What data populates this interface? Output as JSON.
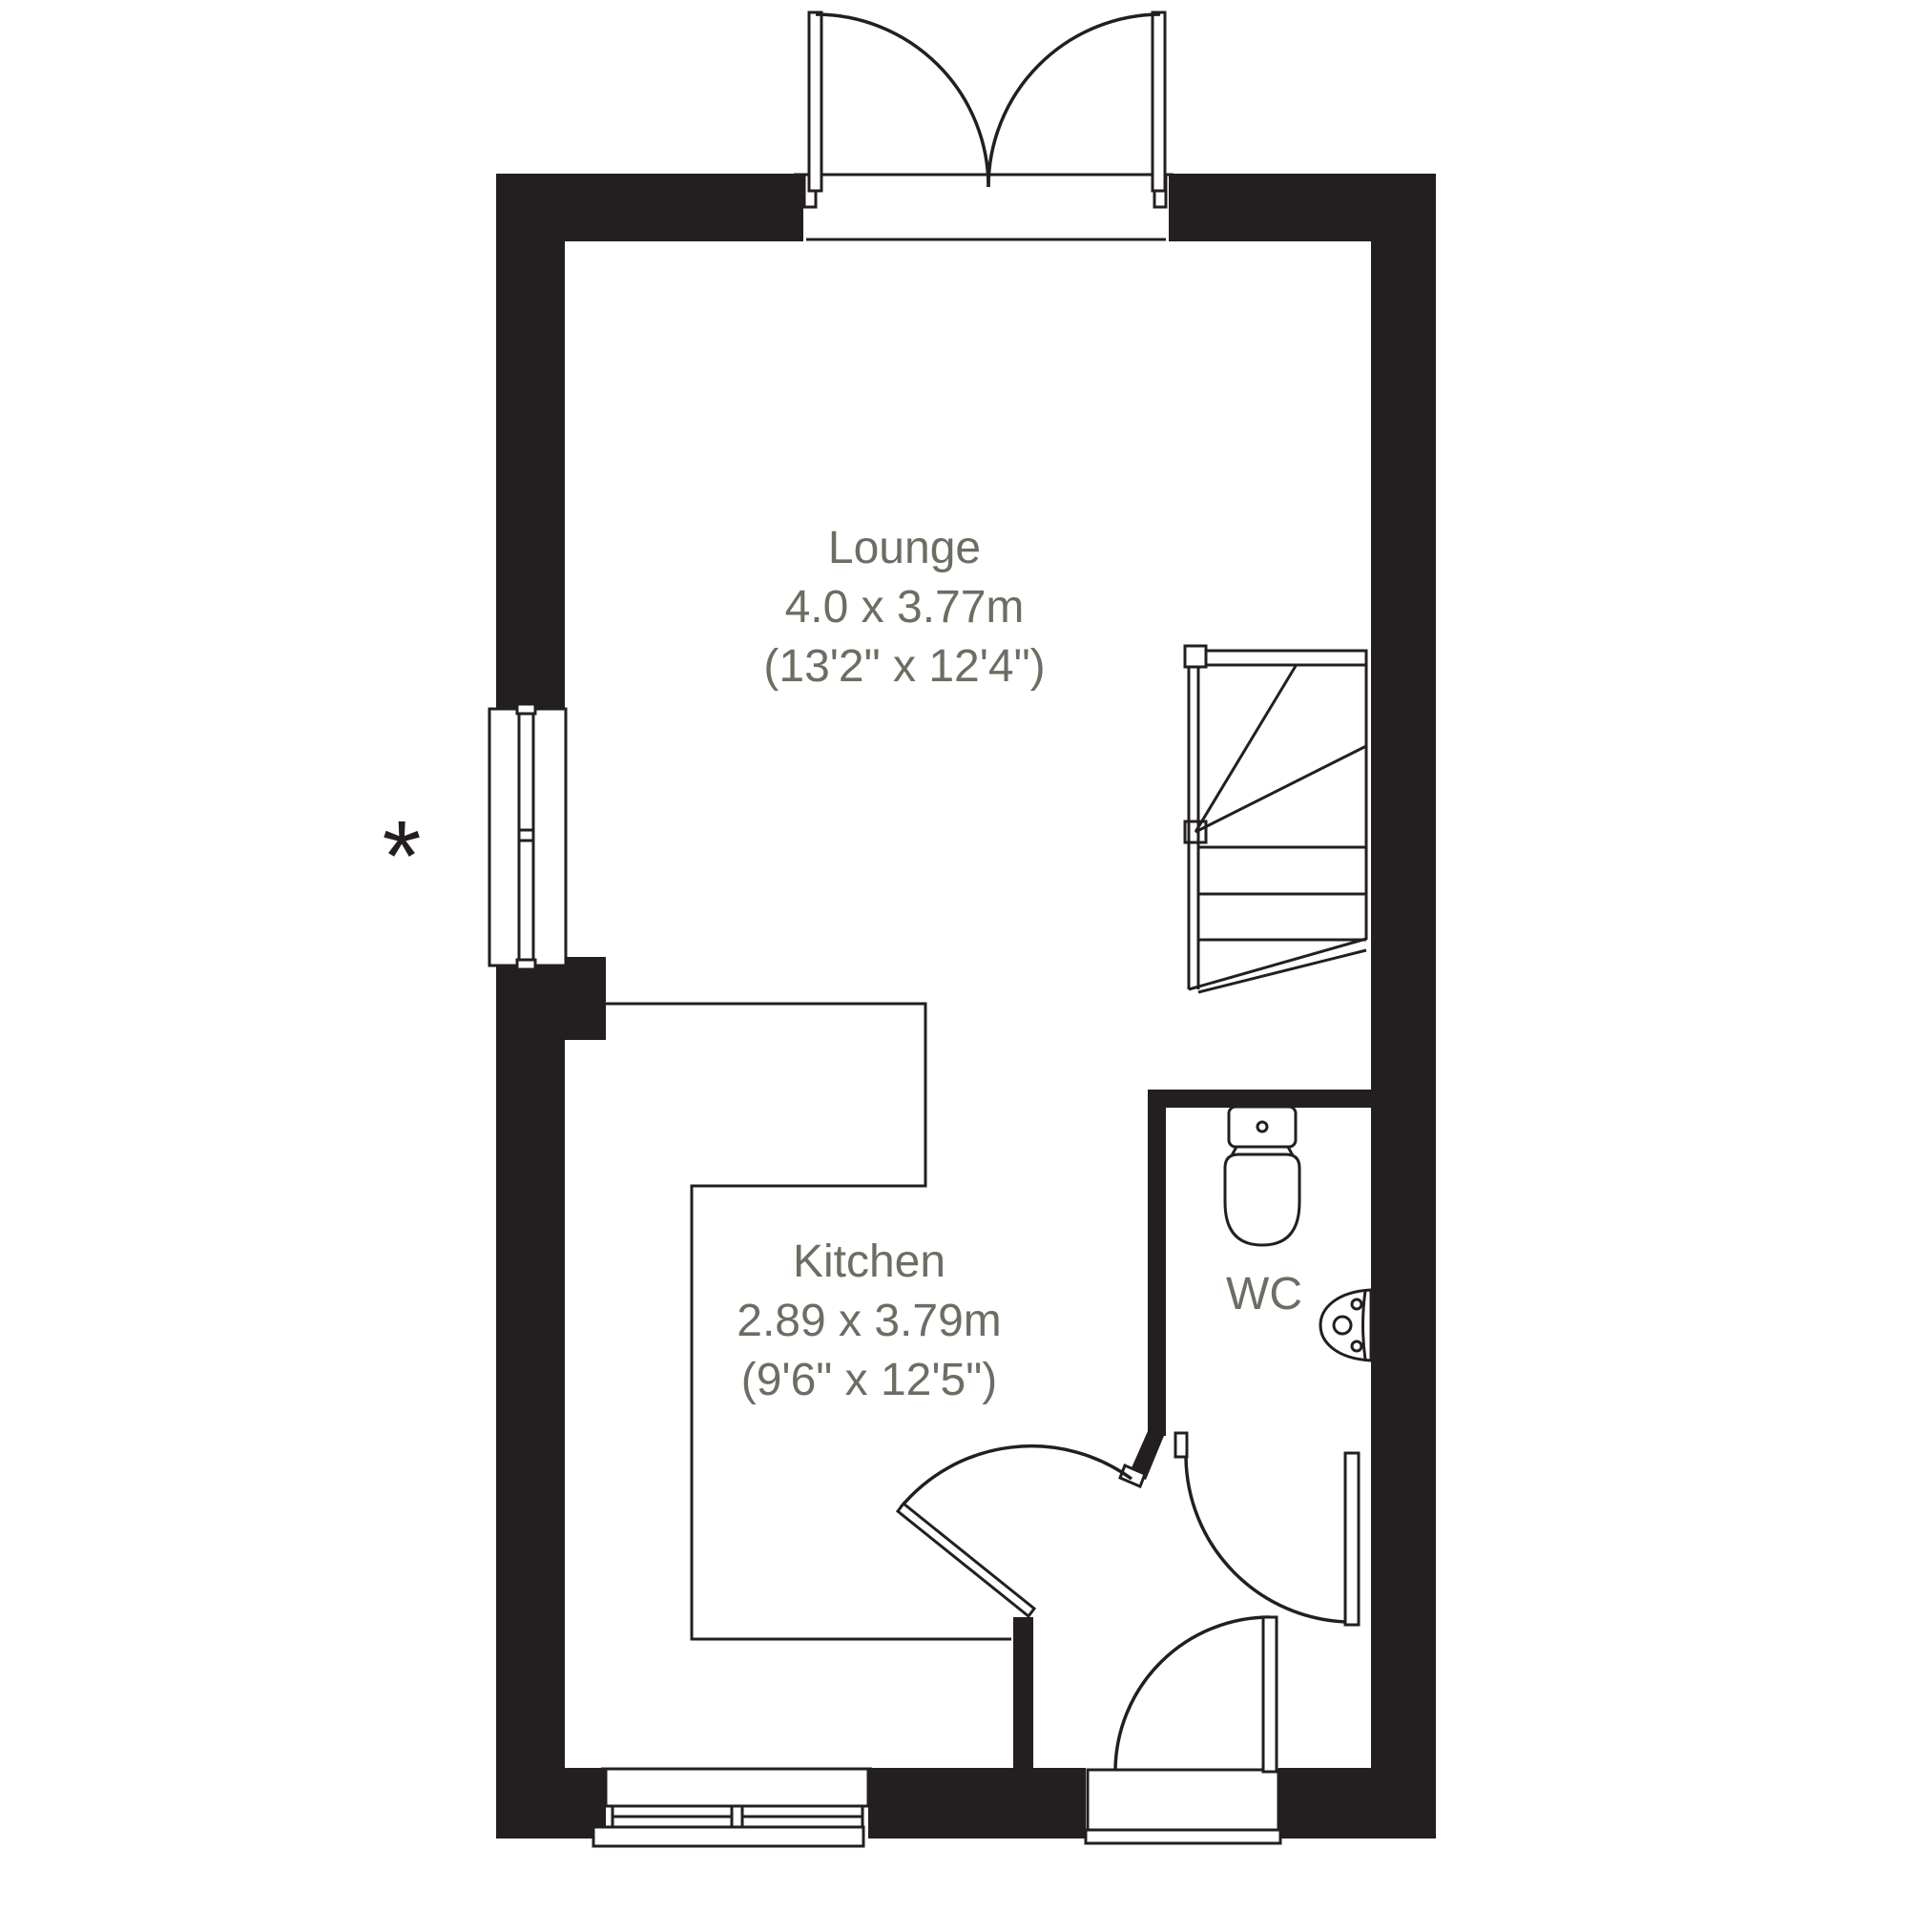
{
  "title": "Ground floor plan",
  "colors": {
    "wall": "#231f20",
    "line": "#231f20",
    "label": "#6a6e63",
    "background": "#ffffff"
  },
  "rooms": {
    "lounge": {
      "name": "Lounge",
      "size_metric": "4.0 x 3.77m",
      "size_imperial": "(13'2\" x 12'4\")"
    },
    "kitchen": {
      "name": "Kitchen",
      "size_metric": "2.89 x 3.79m",
      "size_imperial": "(9'6\" x 12'5\")"
    },
    "wc": {
      "name": "WC"
    }
  },
  "annotations": {
    "window_note_marker": "*"
  }
}
